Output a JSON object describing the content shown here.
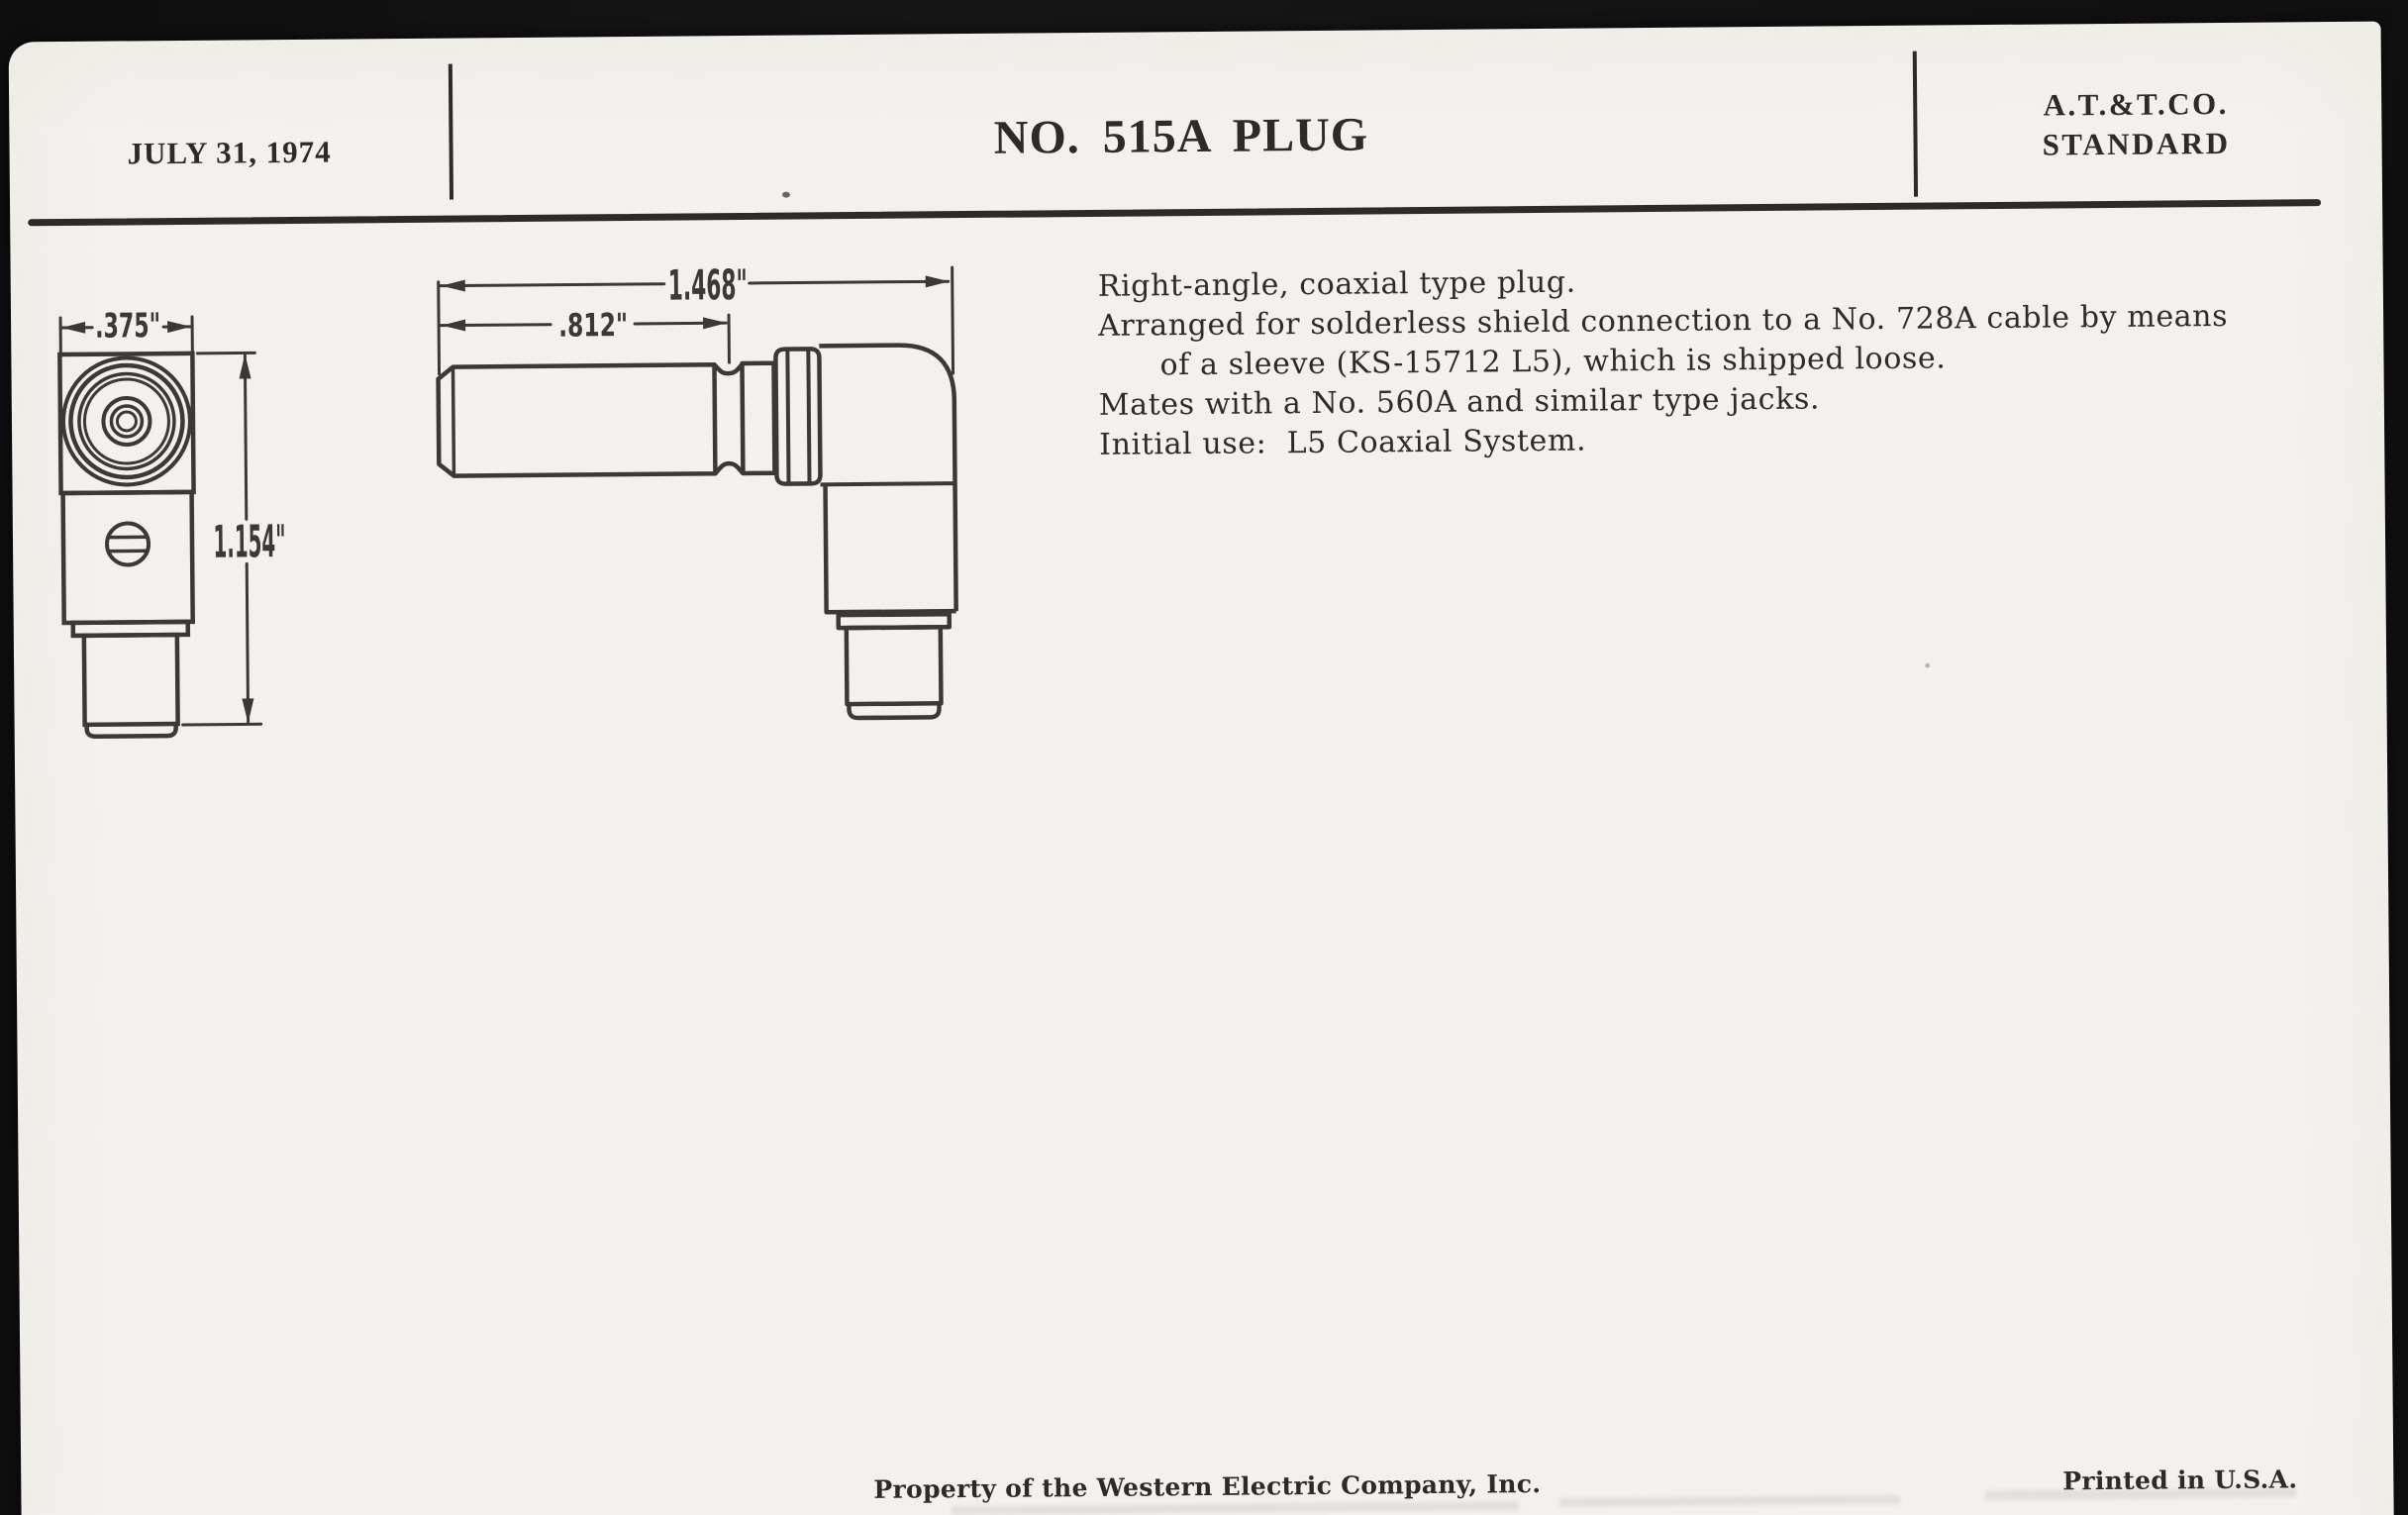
{
  "document": {
    "header": {
      "date": "JULY 31, 1974",
      "title": "NO. 515A PLUG",
      "standard_line1": "A.T.&T.CO.",
      "standard_line2": "STANDARD"
    },
    "description": {
      "line1": "Right-angle, coaxial type plug.",
      "line2": "Arranged for solderless shield connection to a No. 728A cable by means",
      "line2_cont": "of a sleeve (KS-15712 L5), which is shipped loose.",
      "line3": "Mates with a No. 560A and similar type jacks.",
      "line4": "Initial use:  L5 Coaxial System."
    },
    "drawings": {
      "front_view": {
        "width": ".375\"",
        "height": "1.154\""
      },
      "side_view": {
        "overall_length": "1.468\"",
        "barrel_length": ".812\""
      }
    },
    "footer": {
      "property": "Property of the Western Electric Company, Inc.",
      "printed": "Printed in U.S.A."
    }
  },
  "colors": {
    "paper": "#f3f1ed",
    "ink": "#2d2b28",
    "line": "#3b3936",
    "frame": "#131313"
  }
}
